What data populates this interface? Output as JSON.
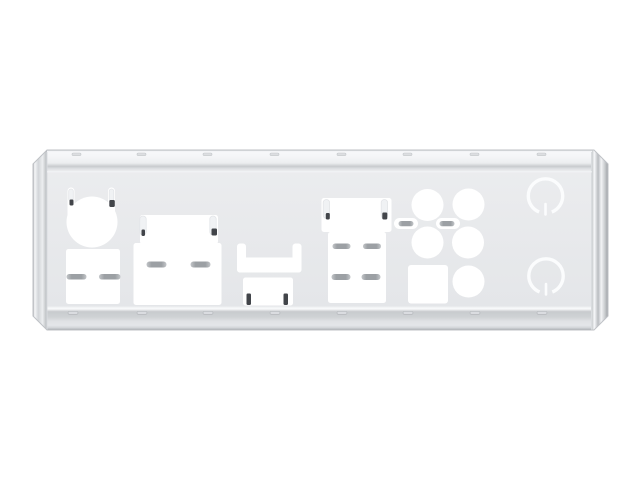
{
  "scene": {
    "subject": "metal-io-shield-back-plate",
    "background": "#ffffff"
  },
  "colors": {
    "background": "#ffffff",
    "cutout_white": "#ffffff",
    "plate_top": "#ecedef",
    "plate_bottom": "#e3e5e8",
    "flange_bright": "#f7f8fa",
    "flange_shadow": "#c6c9cc",
    "edge_dark": "#9b9ea2",
    "outline": "#bfc2c6",
    "fold_line": "#c8cbce",
    "notch_top_fill": "#dcdee1",
    "notch_top_stroke": "#c4c7ca",
    "notch_bottom_fill": "#dadce0",
    "notch_bottom_stroke": "#b2b5b9",
    "spring_tab_fill": "#f0f2f4",
    "spring_tab_stroke": "#e3e5e8",
    "pill_gray": "#9ca0a4",
    "pill_end": "#c3c6c9",
    "tick_dark": "#42454a",
    "knockout_ring": "#fbfcfd"
  },
  "shield": {
    "frame": {
      "x": 33,
      "y": 150,
      "width": 575,
      "height": 180,
      "chamfer": 14
    },
    "top_notches": {
      "y": 153,
      "w": 9,
      "h": 2.6,
      "x": [
        72,
        137,
        203,
        270,
        337,
        403,
        470,
        537
      ]
    },
    "bottom_notches": {
      "y": 311.5,
      "w": 10,
      "h": 2.8,
      "x": [
        68,
        137,
        203,
        270,
        337,
        403,
        470,
        537
      ]
    },
    "cutouts": [
      {
        "name": "ps2-port-cutout",
        "shapes": [
          {
            "t": "circle",
            "cx": 92,
            "cy": 222,
            "r": 25.5
          },
          {
            "t": "rect",
            "x": 67.5,
            "y": 187.5,
            "w": 7,
            "h": 30,
            "rx": 3.5
          },
          {
            "t": "rect",
            "x": 108,
            "y": 187.5,
            "w": 7,
            "h": 30,
            "rx": 3.5
          }
        ]
      },
      {
        "name": "usb-stack-cutout-left",
        "shapes": [
          {
            "t": "rect",
            "x": 66,
            "y": 249,
            "w": 54,
            "h": 55,
            "rx": 2.5
          }
        ]
      },
      {
        "name": "lan-usb-combo-cutout-left",
        "shapes": [
          {
            "t": "rect",
            "x": 140,
            "y": 215,
            "w": 78,
            "h": 29,
            "rx": 2.5
          },
          {
            "t": "rect",
            "x": 133.5,
            "y": 243,
            "w": 88,
            "h": 62,
            "rx": 2.5
          }
        ]
      },
      {
        "name": "video-port-clip-cutout",
        "shapes": [
          {
            "t": "rect",
            "x": 237,
            "y": 243.5,
            "w": 9,
            "h": 29,
            "rx": 3
          },
          {
            "t": "rect",
            "x": 292.5,
            "y": 243.5,
            "w": 9,
            "h": 29,
            "rx": 3
          },
          {
            "t": "rect",
            "x": 237,
            "y": 257.5,
            "w": 64.5,
            "h": 15,
            "rx": 3
          }
        ]
      },
      {
        "name": "video-port-cutout",
        "shapes": [
          {
            "t": "rect",
            "x": 243,
            "y": 277.5,
            "w": 50,
            "h": 28,
            "rx": 2.5
          }
        ]
      },
      {
        "name": "lan-usb-combo-cutout-right",
        "shapes": [
          {
            "t": "rect",
            "x": 321.5,
            "y": 198,
            "w": 70,
            "h": 34,
            "rx": 2.5
          },
          {
            "t": "rect",
            "x": 328,
            "y": 232,
            "w": 58,
            "h": 71,
            "rx": 2.5
          }
        ]
      },
      {
        "name": "audio-jack-holes",
        "shapes": [
          {
            "t": "circle",
            "cx": 427.5,
            "cy": 205,
            "r": 16
          },
          {
            "t": "circle",
            "cx": 468.5,
            "cy": 204.5,
            "r": 16
          },
          {
            "t": "circle",
            "cx": 427.5,
            "cy": 242.5,
            "r": 16
          },
          {
            "t": "circle",
            "cx": 468,
            "cy": 242.5,
            "r": 16
          },
          {
            "t": "circle",
            "cx": 468.5,
            "cy": 281.5,
            "r": 16
          }
        ]
      },
      {
        "name": "optical-spdif-cutout",
        "shapes": [
          {
            "t": "rect",
            "x": 408,
            "y": 265,
            "w": 40,
            "h": 38.5,
            "rx": 3
          }
        ]
      },
      {
        "name": "audio-vent-slots",
        "shapes": [
          {
            "t": "rect",
            "x": 394,
            "y": 218,
            "w": 24,
            "h": 11,
            "rx": 5.5
          },
          {
            "t": "rect",
            "x": 436,
            "y": 218,
            "w": 24,
            "h": 11,
            "rx": 5.5
          }
        ]
      }
    ],
    "spring_tabs_faint": [
      {
        "x": 68.7,
        "y": 189,
        "w": 4.6,
        "h": 12,
        "rx": 2.3
      },
      {
        "x": 109.2,
        "y": 189,
        "w": 4.6,
        "h": 12,
        "rx": 2.3
      },
      {
        "x": 139.8,
        "y": 216,
        "w": 6.4,
        "h": 19,
        "rx": 3.2
      },
      {
        "x": 209.8,
        "y": 216,
        "w": 6.4,
        "h": 19,
        "rx": 3.2
      },
      {
        "x": 323.2,
        "y": 199.5,
        "w": 6.4,
        "h": 19,
        "rx": 3.2
      },
      {
        "x": 381.2,
        "y": 199.5,
        "w": 6.4,
        "h": 19,
        "rx": 3.2
      }
    ],
    "spring_finger_pills": [
      {
        "x": 66.5,
        "y": 274,
        "w": 20,
        "h": 5.5
      },
      {
        "x": 99,
        "y": 274,
        "w": 21.5,
        "h": 5.5
      },
      {
        "x": 146.5,
        "y": 261.5,
        "w": 20,
        "h": 6
      },
      {
        "x": 190.5,
        "y": 261.5,
        "w": 20,
        "h": 6
      },
      {
        "x": 332.5,
        "y": 243.5,
        "w": 18,
        "h": 5.5
      },
      {
        "x": 363,
        "y": 243.5,
        "w": 18,
        "h": 5.5
      },
      {
        "x": 331.5,
        "y": 274,
        "w": 19,
        "h": 6
      },
      {
        "x": 361.5,
        "y": 274,
        "w": 19,
        "h": 6
      },
      {
        "x": 398.5,
        "y": 221,
        "w": 15,
        "h": 5.2
      },
      {
        "x": 439.5,
        "y": 221,
        "w": 15,
        "h": 5.2
      }
    ],
    "bent_tab_ticks": [
      {
        "x": 69.5,
        "y": 199.5,
        "w": 4,
        "h": 6
      },
      {
        "x": 109.3,
        "y": 200,
        "w": 5.5,
        "h": 7
      },
      {
        "x": 141.5,
        "y": 229.5,
        "w": 3.5,
        "h": 6.5
      },
      {
        "x": 211.5,
        "y": 228.5,
        "w": 5.5,
        "h": 7
      },
      {
        "x": 325.8,
        "y": 213,
        "w": 4,
        "h": 6.5
      },
      {
        "x": 382.3,
        "y": 212.5,
        "w": 5,
        "h": 7
      },
      {
        "x": 246.5,
        "y": 293.5,
        "w": 4.5,
        "h": 11.5
      },
      {
        "x": 283.5,
        "y": 293.5,
        "w": 4.5,
        "h": 11.5
      }
    ],
    "knockout_rings": {
      "r": 17.2,
      "stroke_width": 3.4,
      "gap": 13,
      "tick_width": 2.6,
      "items": [
        {
          "name": "antenna-knockout-ring-top",
          "cx": 545.5,
          "cy": 196
        },
        {
          "name": "antenna-knockout-ring-bottom",
          "cx": 546,
          "cy": 276
        }
      ]
    }
  }
}
